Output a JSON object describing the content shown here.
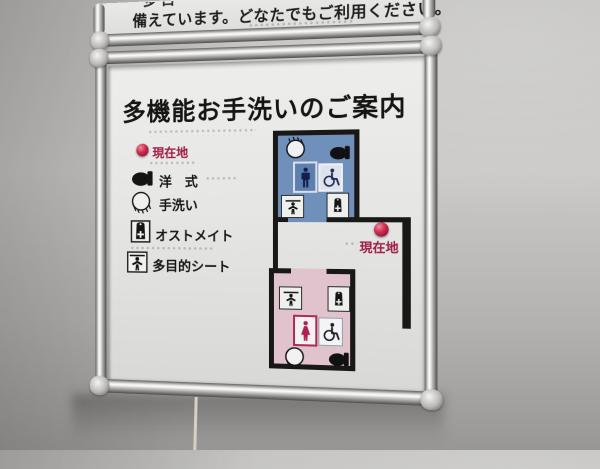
{
  "top_sign": {
    "partial_line": "多目",
    "line": "備えています。どなたでもご利用ください。"
  },
  "sign": {
    "title": "多機能お手洗いのご案内",
    "legend": [
      {
        "label": "現在地",
        "icon": "current-location-dot",
        "label_color": "#9e1b45"
      },
      {
        "label": "洋　式",
        "icon": "western-toilet-icon"
      },
      {
        "label": "手洗い",
        "icon": "hand-wash-icon"
      },
      {
        "label": "オストメイト",
        "icon": "ostomate-icon"
      },
      {
        "label": "多目的シート",
        "icon": "care-sheet-icon"
      }
    ],
    "map": {
      "current_location_label": "現在地",
      "rooms": [
        {
          "id": "mens-multifunction-room",
          "fill": "#7090bc",
          "icons": [
            "hand-wash-icon",
            "western-toilet-icon",
            "male-icon",
            "wheelchair-icon",
            "care-sheet-icon",
            "ostomate-icon"
          ]
        },
        {
          "id": "womens-multifunction-room",
          "fill": "#e0c3cc",
          "icons": [
            "care-sheet-icon",
            "ostomate-icon",
            "female-icon",
            "wheelchair-icon",
            "hand-wash-icon",
            "western-toilet-icon"
          ]
        }
      ]
    }
  },
  "colors": {
    "wall_line": "#181816",
    "mens_room": "#7090bc",
    "womens_room": "#e0c3cc",
    "current_location_red": "#b01c40",
    "label_red": "#9e1b45",
    "sign_face": "#e8e8e6",
    "frame_silver": "#c9c8c6"
  }
}
